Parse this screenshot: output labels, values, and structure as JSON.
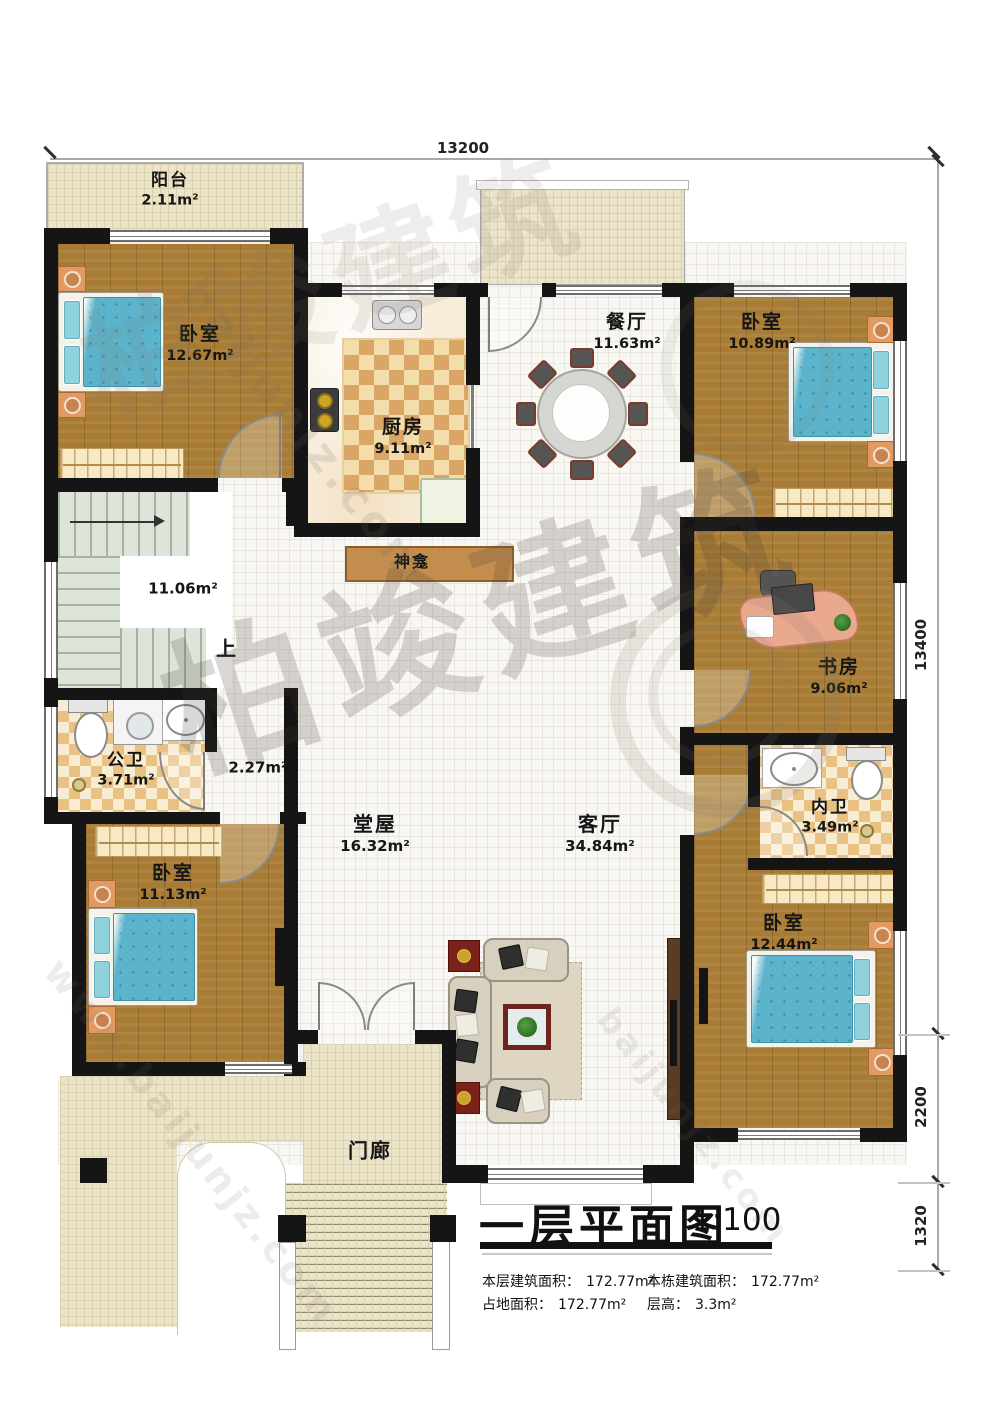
{
  "plan": {
    "dimensions": {
      "top": "13200",
      "right_total": "13400",
      "right_lower": "2200",
      "right_bottom": "1320"
    },
    "rooms": {
      "balcony": {
        "name": "阳台",
        "area": "2.11m²"
      },
      "bedroom_tl": {
        "name": "卧室",
        "area": "12.67m²"
      },
      "kitchen": {
        "name": "厨房",
        "area": "9.11m²"
      },
      "dining": {
        "name": "餐厅",
        "area": "11.63m²"
      },
      "bedroom_tr": {
        "name": "卧室",
        "area": "10.89m²"
      },
      "study": {
        "name": "书房",
        "area": "9.06m²"
      },
      "inner_bath": {
        "name": "内卫",
        "area": "3.49m²"
      },
      "bedroom_br": {
        "name": "卧室",
        "area": "12.44m²"
      },
      "stairwell": {
        "area": "11.06m²",
        "up_label": "上"
      },
      "shrine": {
        "name": "神龛"
      },
      "public_bath": {
        "name": "公卫",
        "area": "3.71m²"
      },
      "corridor": {
        "area": "2.27m²"
      },
      "bedroom_bl": {
        "name": "卧室",
        "area": "11.13m²"
      },
      "hall": {
        "name": "堂屋",
        "area": "16.32m²"
      },
      "living": {
        "name": "客厅",
        "area": "34.84m²"
      },
      "porch": {
        "name": "门廊"
      }
    }
  },
  "title_block": {
    "title": "一层平面图",
    "scale": "1:100",
    "stats": [
      {
        "label": "本层建筑面积：",
        "value": "172.77m²"
      },
      {
        "label": "本栋建筑面积：",
        "value": "172.77m²"
      },
      {
        "label": "占地面积：",
        "value": "172.77m²"
      },
      {
        "label": "层高：",
        "value": "3.3m²"
      }
    ]
  },
  "watermark": {
    "brand": "柏竣建筑",
    "domain": "baijunjz.com",
    "url": "www.baijunjz.com"
  },
  "colors": {
    "wall": "#151515",
    "wood_floor": "#a87c35",
    "cream_tile": "#ebe4c8",
    "checker_tan": "#e9c183",
    "bed_blue": "#5cb4cc",
    "accent_red": "#7a221a"
  }
}
